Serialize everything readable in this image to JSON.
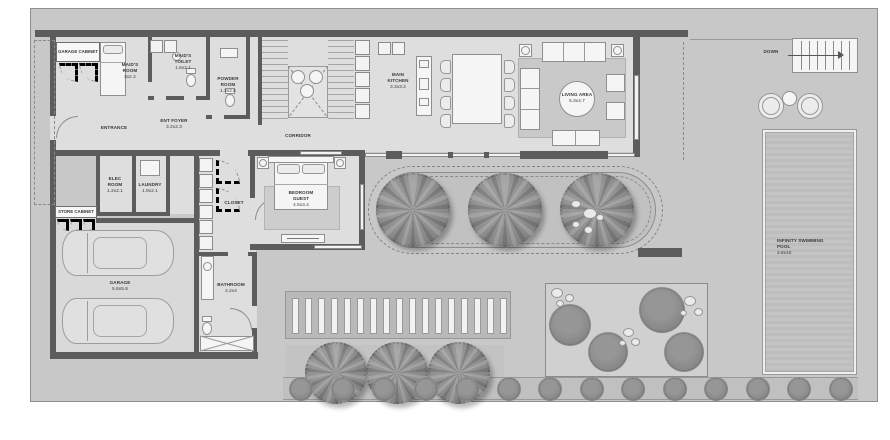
{
  "rooms": {
    "garage_cabinet": {
      "name": "GARAGE CABINET"
    },
    "maids_room": {
      "name": "MAID'S ROOM",
      "dims": "3x2.2"
    },
    "maids_toilet": {
      "name": "MAID'S TOILET",
      "dims": "1.8x2.1"
    },
    "powder_room": {
      "name": "POWDER ROOM",
      "dims": "1.3x2.6"
    },
    "entrance": {
      "name": "ENTRANCE"
    },
    "ent_foyer": {
      "name": "ENT FOYER",
      "dims": "3.2x2.3"
    },
    "corridor": {
      "name": "CORRIDOR"
    },
    "main_kitchen": {
      "name": "MAIN KITCHEN",
      "dims": "3.3x3.2"
    },
    "living_area": {
      "name": "LIVING AREA",
      "dims": "6.3x4.7"
    },
    "stairs": {
      "down_label": "DOWN"
    },
    "elec_room": {
      "name": "ELEC ROOM",
      "dims": "1.2x2.1"
    },
    "laundry": {
      "name": "LAUNDRY",
      "dims": "1.9x2.1"
    },
    "store_cabinet": {
      "name": "STORE CABINET"
    },
    "closet": {
      "name": "CLOSET"
    },
    "bedroom_guest": {
      "name": "BEDROOM GUEST",
      "dims": "4.5x3.4"
    },
    "garage": {
      "name": "GARAGE",
      "dims": "5.8x5.8"
    },
    "bathroom": {
      "name": "BATHROOM",
      "dims": "2.2x4"
    },
    "pool": {
      "name": "INFINITY SWIMMING POOL",
      "dims": "3.8x10"
    }
  },
  "colors": {
    "wall": "#5c5c5c",
    "indoor_floor": "#dedede",
    "outdoor_ground": "#c8c8c8",
    "foliage": "#8b8b8b",
    "pool_water": "#bfbfbf"
  }
}
